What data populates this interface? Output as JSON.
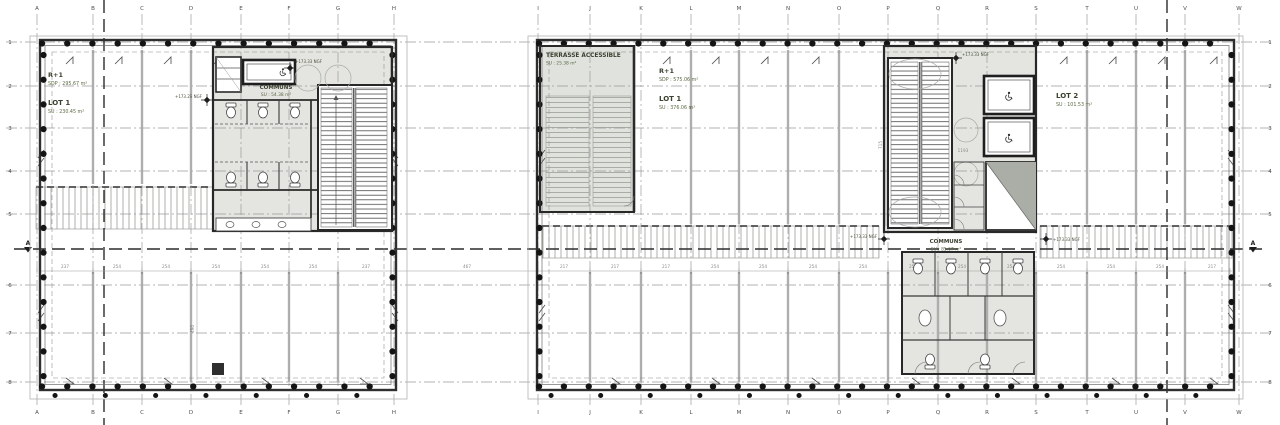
{
  "drawing": {
    "floor": "R+1"
  },
  "grid": {
    "left_letters": [
      "A",
      "B",
      "C",
      "D",
      "E",
      "F",
      "G",
      "H"
    ],
    "right_letters": [
      "I",
      "J",
      "K",
      "L",
      "M",
      "N",
      "O",
      "P",
      "Q",
      "R",
      "S",
      "T",
      "U",
      "V",
      "W"
    ],
    "rows": [
      "1",
      "2",
      "3",
      "4",
      "5",
      "6",
      "7",
      "8"
    ],
    "section_marker": "A"
  },
  "left_plan": {
    "floor": "R+1",
    "floor_area": "SDP : 295.67 m²",
    "lot": "LOT 1",
    "lot_area": "SU : 230.45 m²",
    "communs": "COMMUNS",
    "communs_area": "SU : 54.38 m²",
    "level_mark_interior": "+173.29 NGF",
    "level_mark_core": "+173.33 NGF",
    "bay_dims": [
      "237",
      "254",
      "254",
      "254",
      "254",
      "254",
      "237"
    ],
    "vert_dim": "490"
  },
  "right_plan": {
    "terrace": "TERRASSE ACCESSIBLE",
    "terrace_area": "SU : 25.38 m²",
    "floor": "R+1",
    "floor_area": "SDP : 575.06 m²",
    "lot1": "LOT 1",
    "lot1_area": "SU : 376.06 m²",
    "lot2": "LOT 2",
    "lot2_area": "SU : 101.53 m²",
    "communs": "COMMUNS",
    "communs_area": "SU : 85.67 m²",
    "level_mark_top": "+173.33 NGF",
    "level_mark_left": "+173.33 NGF",
    "level_mark_right": "+173.33 NGF",
    "bay_dims": [
      "217",
      "217",
      "217",
      "254",
      "254",
      "254",
      "254",
      "254",
      "254",
      "254",
      "254",
      "254",
      "254",
      "217"
    ],
    "vert_dim_1": "715",
    "vert_dim_2": "1193"
  },
  "gap_dim": "467",
  "colors": {
    "ink": "#2f2f2f",
    "grid": "#9b9b9b",
    "core_tint": "#e4e5e0",
    "label_green": "#4c5a39"
  }
}
